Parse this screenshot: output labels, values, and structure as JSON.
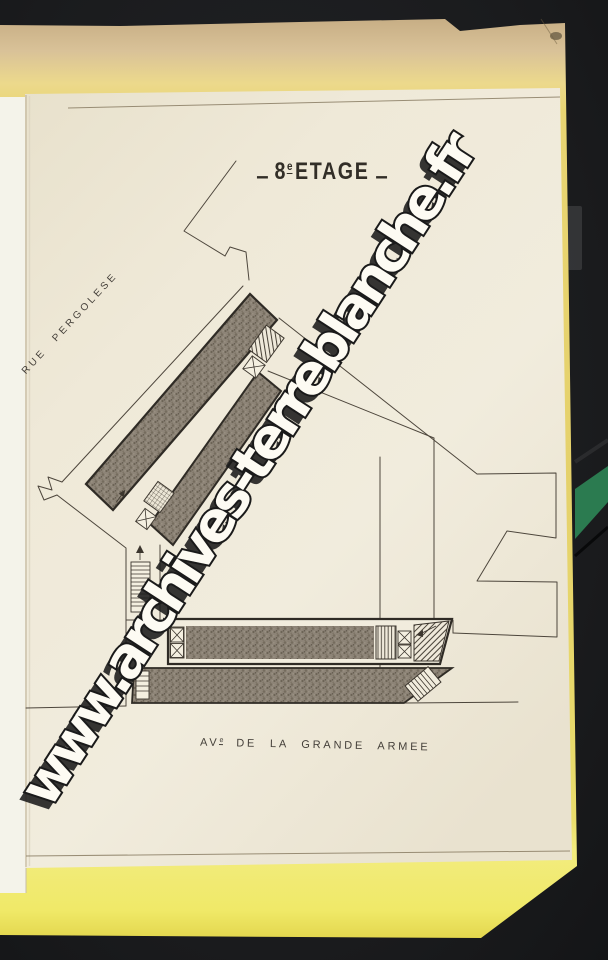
{
  "title": {
    "dash": "‒",
    "number": "8",
    "ordinal": "e",
    "word": "ETAGE"
  },
  "streets": {
    "left": "RUE PERGOLESE",
    "bottom_prefix": "AV",
    "bottom_ordinal": "e",
    "bottom_rest": "DE LA GRANDE ARMEE"
  },
  "watermark": {
    "text": "www.archives-terreblanche.fr"
  },
  "colors": {
    "bg": "#1b1c1e",
    "paper": "#f0ebdc",
    "underpage": "#f4f3ea",
    "folder-yellow": "#eada74",
    "folder-tan": "#d8c096",
    "ink": "#2f2b25",
    "line": "#4d463c",
    "title-ink": "#322e27",
    "label-ink": "#45403a",
    "poche-gray": "#8c8478",
    "green-stripe": "#2b7b50",
    "wm-fill": "#fdfbf3",
    "wm-outline": "#1a1a1a"
  }
}
